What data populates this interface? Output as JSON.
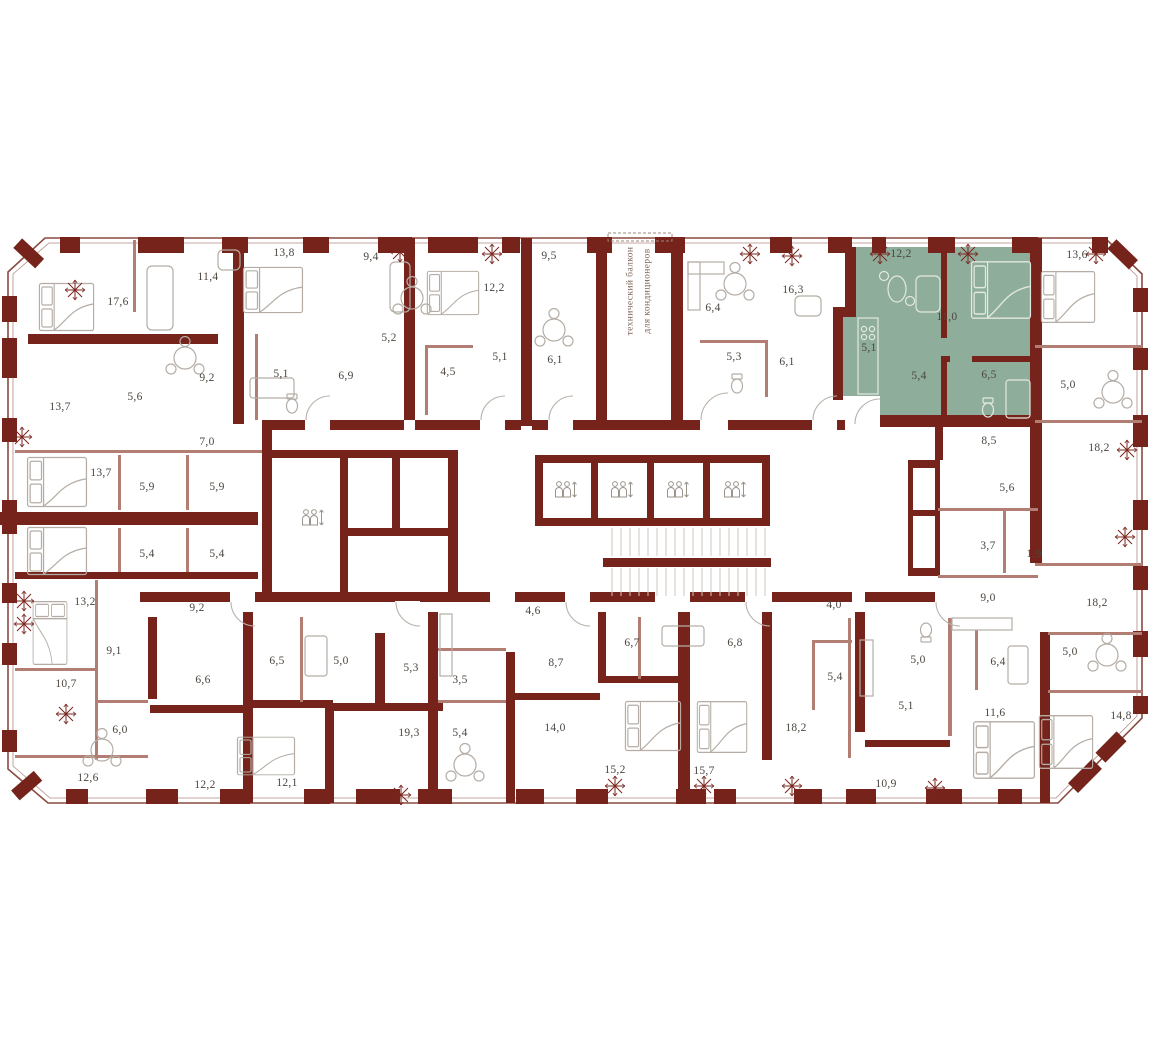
{
  "plan": {
    "type": "residential-floor-plan",
    "language": "ru",
    "colors": {
      "wall": "#75231b",
      "thin_wall": "#b27e74",
      "furniture": "#b5ada5",
      "highlight_fill": "#8fad9b",
      "label_text": "#4c463f",
      "decor_star": "#7a241c"
    },
    "balcony_note": {
      "line1": "технический балкон",
      "line2": "для кондиционеров"
    },
    "labels": [
      {
        "x": 118,
        "y": 302,
        "v": "17,6"
      },
      {
        "x": 208,
        "y": 277,
        "v": "11,4"
      },
      {
        "x": 284,
        "y": 253,
        "v": "13,8"
      },
      {
        "x": 371,
        "y": 257,
        "v": "9,4"
      },
      {
        "x": 494,
        "y": 288,
        "v": "12,2"
      },
      {
        "x": 549,
        "y": 256,
        "v": "9,5"
      },
      {
        "x": 207,
        "y": 378,
        "v": "9,2"
      },
      {
        "x": 281,
        "y": 374,
        "v": "5,1"
      },
      {
        "x": 346,
        "y": 376,
        "v": "6,9"
      },
      {
        "x": 389,
        "y": 338,
        "v": "5,2"
      },
      {
        "x": 448,
        "y": 372,
        "v": "4,5"
      },
      {
        "x": 500,
        "y": 357,
        "v": "5,1"
      },
      {
        "x": 555,
        "y": 360,
        "v": "6,1"
      },
      {
        "x": 60,
        "y": 407,
        "v": "13,7"
      },
      {
        "x": 135,
        "y": 397,
        "v": "5,6"
      },
      {
        "x": 207,
        "y": 442,
        "v": "7,0"
      },
      {
        "x": 713,
        "y": 308,
        "v": "6,4"
      },
      {
        "x": 734,
        "y": 357,
        "v": "5,3"
      },
      {
        "x": 787,
        "y": 362,
        "v": "6,1"
      },
      {
        "x": 793,
        "y": 290,
        "v": "16,3"
      },
      {
        "x": 901,
        "y": 254,
        "v": "12,2",
        "hl": true
      },
      {
        "x": 947,
        "y": 317,
        "v": "11,0",
        "hl": true
      },
      {
        "x": 869,
        "y": 348,
        "v": "5,1",
        "hl": true
      },
      {
        "x": 919,
        "y": 376,
        "v": "5,4",
        "hl": true
      },
      {
        "x": 989,
        "y": 375,
        "v": "6,5",
        "hl": true
      },
      {
        "x": 1077,
        "y": 255,
        "v": "13,6"
      },
      {
        "x": 1068,
        "y": 385,
        "v": "5,0"
      },
      {
        "x": 989,
        "y": 441,
        "v": "8,5"
      },
      {
        "x": 1099,
        "y": 448,
        "v": "18,2"
      },
      {
        "x": 101,
        "y": 473,
        "v": "13,7"
      },
      {
        "x": 147,
        "y": 487,
        "v": "5,9"
      },
      {
        "x": 217,
        "y": 487,
        "v": "5,9"
      },
      {
        "x": 147,
        "y": 554,
        "v": "5,4"
      },
      {
        "x": 217,
        "y": 554,
        "v": "5,4"
      },
      {
        "x": 85,
        "y": 602,
        "v": "13,2"
      },
      {
        "x": 197,
        "y": 608,
        "v": "9,2"
      },
      {
        "x": 533,
        "y": 611,
        "v": "4,6"
      },
      {
        "x": 834,
        "y": 605,
        "v": "4,0"
      },
      {
        "x": 1007,
        "y": 488,
        "v": "5,6"
      },
      {
        "x": 988,
        "y": 546,
        "v": "3,7"
      },
      {
        "x": 1034,
        "y": 554,
        "v": "1,9"
      },
      {
        "x": 988,
        "y": 598,
        "v": "9,0"
      },
      {
        "x": 1097,
        "y": 603,
        "v": "18,2"
      },
      {
        "x": 114,
        "y": 651,
        "v": "9,1"
      },
      {
        "x": 66,
        "y": 684,
        "v": "10,7"
      },
      {
        "x": 203,
        "y": 680,
        "v": "6,6"
      },
      {
        "x": 277,
        "y": 661,
        "v": "6,5"
      },
      {
        "x": 341,
        "y": 661,
        "v": "5,0"
      },
      {
        "x": 411,
        "y": 668,
        "v": "5,3"
      },
      {
        "x": 460,
        "y": 680,
        "v": "3,5"
      },
      {
        "x": 556,
        "y": 663,
        "v": "8,7"
      },
      {
        "x": 632,
        "y": 643,
        "v": "6,7"
      },
      {
        "x": 735,
        "y": 643,
        "v": "6,8"
      },
      {
        "x": 120,
        "y": 730,
        "v": "6,0"
      },
      {
        "x": 88,
        "y": 778,
        "v": "12,6"
      },
      {
        "x": 205,
        "y": 785,
        "v": "12,2"
      },
      {
        "x": 287,
        "y": 783,
        "v": "12,1"
      },
      {
        "x": 409,
        "y": 733,
        "v": "19,3"
      },
      {
        "x": 460,
        "y": 733,
        "v": "5,4"
      },
      {
        "x": 555,
        "y": 728,
        "v": "14,0"
      },
      {
        "x": 615,
        "y": 770,
        "v": "15,2"
      },
      {
        "x": 704,
        "y": 771,
        "v": "15,7"
      },
      {
        "x": 796,
        "y": 728,
        "v": "18,2"
      },
      {
        "x": 835,
        "y": 677,
        "v": "5,4"
      },
      {
        "x": 918,
        "y": 660,
        "v": "5,0"
      },
      {
        "x": 998,
        "y": 662,
        "v": "6,4"
      },
      {
        "x": 1070,
        "y": 652,
        "v": "5,0"
      },
      {
        "x": 906,
        "y": 706,
        "v": "5,1"
      },
      {
        "x": 995,
        "y": 713,
        "v": "11,6"
      },
      {
        "x": 1121,
        "y": 716,
        "v": "14,8"
      },
      {
        "x": 886,
        "y": 784,
        "v": "10,9"
      }
    ],
    "stars": [
      {
        "x": 75,
        "y": 290
      },
      {
        "x": 400,
        "y": 252
      },
      {
        "x": 492,
        "y": 254
      },
      {
        "x": 750,
        "y": 254
      },
      {
        "x": 792,
        "y": 256
      },
      {
        "x": 880,
        "y": 254
      },
      {
        "x": 968,
        "y": 254
      },
      {
        "x": 1096,
        "y": 254
      },
      {
        "x": 22,
        "y": 437
      },
      {
        "x": 24,
        "y": 601
      },
      {
        "x": 24,
        "y": 624
      },
      {
        "x": 66,
        "y": 714
      },
      {
        "x": 401,
        "y": 795
      },
      {
        "x": 615,
        "y": 786
      },
      {
        "x": 704,
        "y": 786
      },
      {
        "x": 792,
        "y": 786
      },
      {
        "x": 935,
        "y": 788
      },
      {
        "x": 1127,
        "y": 450
      },
      {
        "x": 1125,
        "y": 537
      }
    ],
    "elevators": [
      {
        "x": 565,
        "y": 490
      },
      {
        "x": 621,
        "y": 490
      },
      {
        "x": 677,
        "y": 490
      },
      {
        "x": 734,
        "y": 490
      },
      {
        "x": 312,
        "y": 518
      }
    ]
  }
}
